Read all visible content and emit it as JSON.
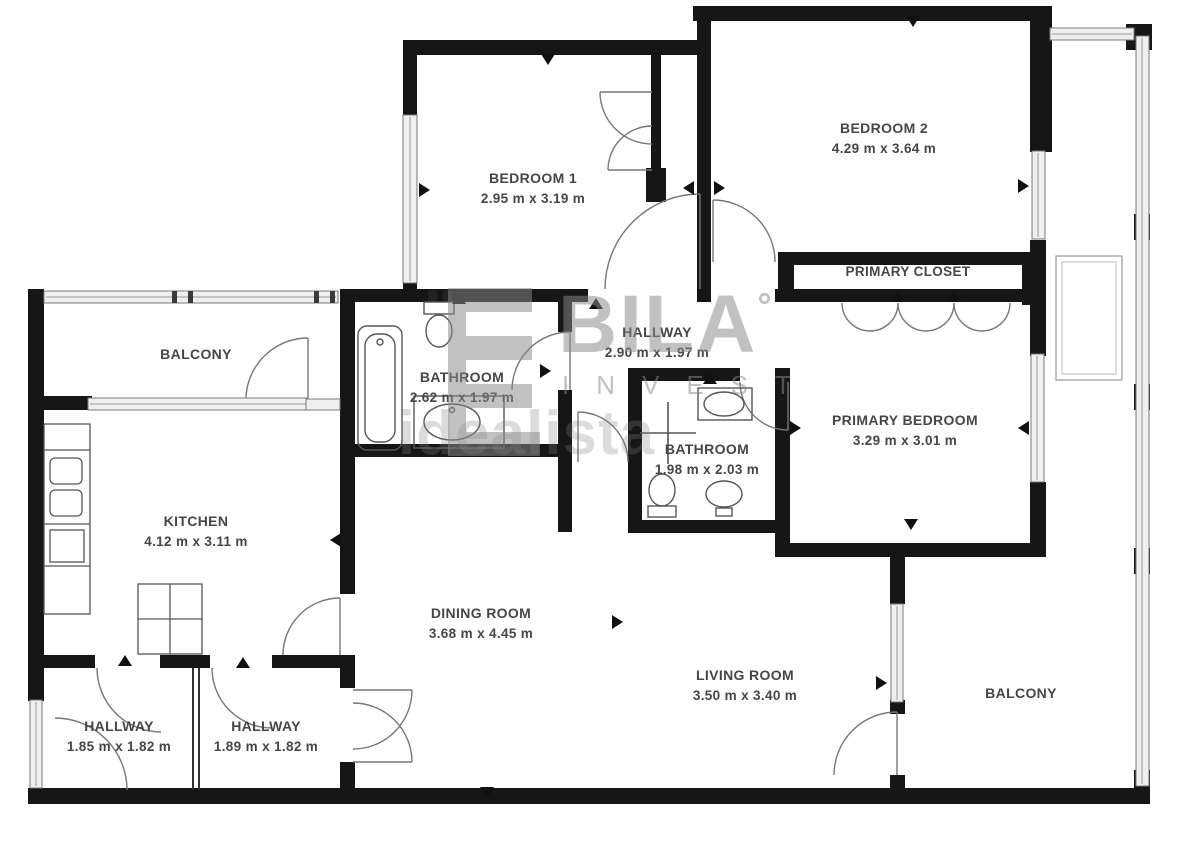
{
  "plan_title": "apartment-floor-plan",
  "units": "m",
  "colors": {
    "wall": "#161616",
    "glazing_fill": "#efefef",
    "glazing_stroke": "#7a7a7a",
    "label_text": "#464646",
    "fixture_stroke": "#555555",
    "watermark_gray": "#8a8a8a"
  },
  "rooms": [
    {
      "id": "bedroom-1",
      "name": "BEDROOM 1",
      "dims": "2.95 m x 3.19 m"
    },
    {
      "id": "bedroom-2",
      "name": "BEDROOM 2",
      "dims": "4.29 m x 3.64 m"
    },
    {
      "id": "primary-closet",
      "name": "PRIMARY CLOSET",
      "dims": ""
    },
    {
      "id": "hallway-center",
      "name": "HALLWAY",
      "dims": "2.90 m x 1.97 m"
    },
    {
      "id": "bathroom-main",
      "name": "BATHROOM",
      "dims": "2.62 m x 1.97 m"
    },
    {
      "id": "bathroom-ensuite",
      "name": "BATHROOM",
      "dims": "1.98 m x 2.03 m"
    },
    {
      "id": "primary-bedroom",
      "name": "PRIMARY BEDROOM",
      "dims": "3.29 m x 3.01 m"
    },
    {
      "id": "balcony-top",
      "name": "BALCONY",
      "dims": ""
    },
    {
      "id": "kitchen",
      "name": "KITCHEN",
      "dims": "4.12 m x 3.11 m"
    },
    {
      "id": "dining-room",
      "name": "DINING ROOM",
      "dims": "3.68 m x 4.45 m"
    },
    {
      "id": "living-room",
      "name": "LIVING ROOM",
      "dims": "3.50 m x 3.40 m"
    },
    {
      "id": "balcony-right",
      "name": "BALCONY",
      "dims": ""
    },
    {
      "id": "hallway-entry-left",
      "name": "HALLWAY",
      "dims": "1.85 m x 1.82 m"
    },
    {
      "id": "hallway-entry-right",
      "name": "HALLWAY",
      "dims": "1.89 m x 1.82 m"
    }
  ],
  "watermark": {
    "brand": "BILA",
    "degree": "°",
    "subtitle": "INVEST",
    "portal": "idealista"
  }
}
